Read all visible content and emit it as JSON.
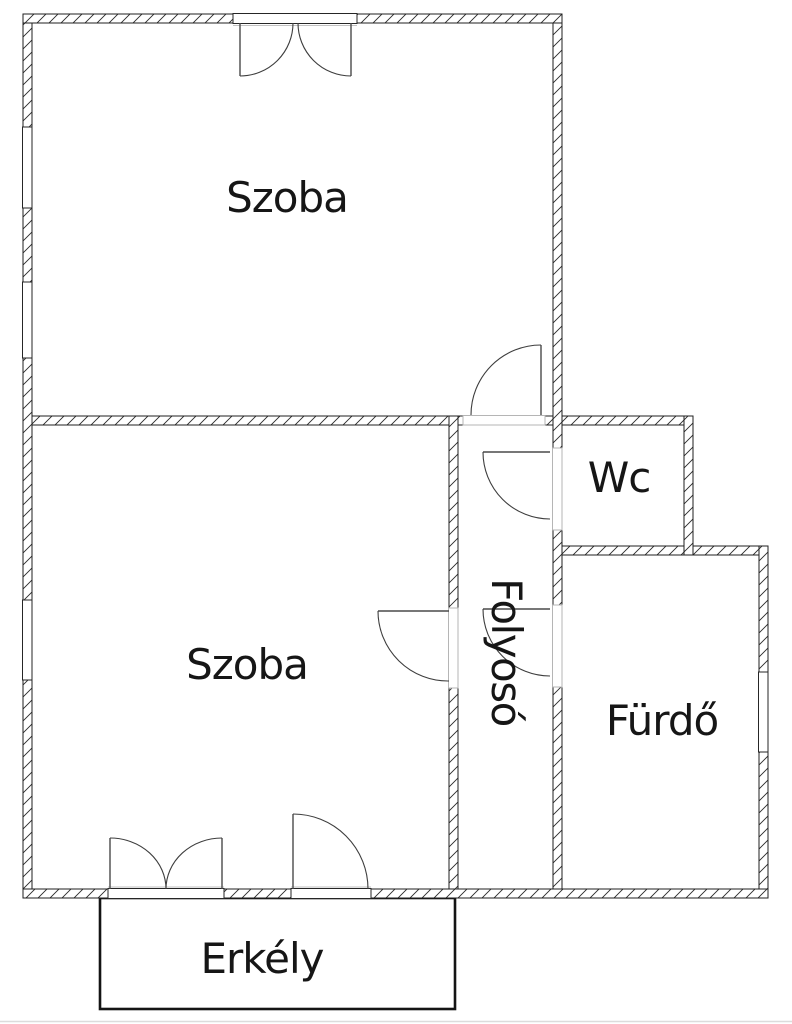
{
  "diagram_type": "apartment floor plan",
  "rooms": [
    {
      "id": "szoba-top",
      "label": "Szoba"
    },
    {
      "id": "szoba-bottom",
      "label": "Szoba"
    },
    {
      "id": "wc",
      "label": "Wc"
    },
    {
      "id": "folyoso",
      "label": "Folyosó"
    },
    {
      "id": "furdo",
      "label": "Fürdő"
    },
    {
      "id": "erkely",
      "label": "Erkély"
    }
  ],
  "colors": {
    "text": "#161616",
    "wall_line": "#1f1f1f",
    "casing": "#b5b5b5",
    "background": "#ffffff"
  }
}
